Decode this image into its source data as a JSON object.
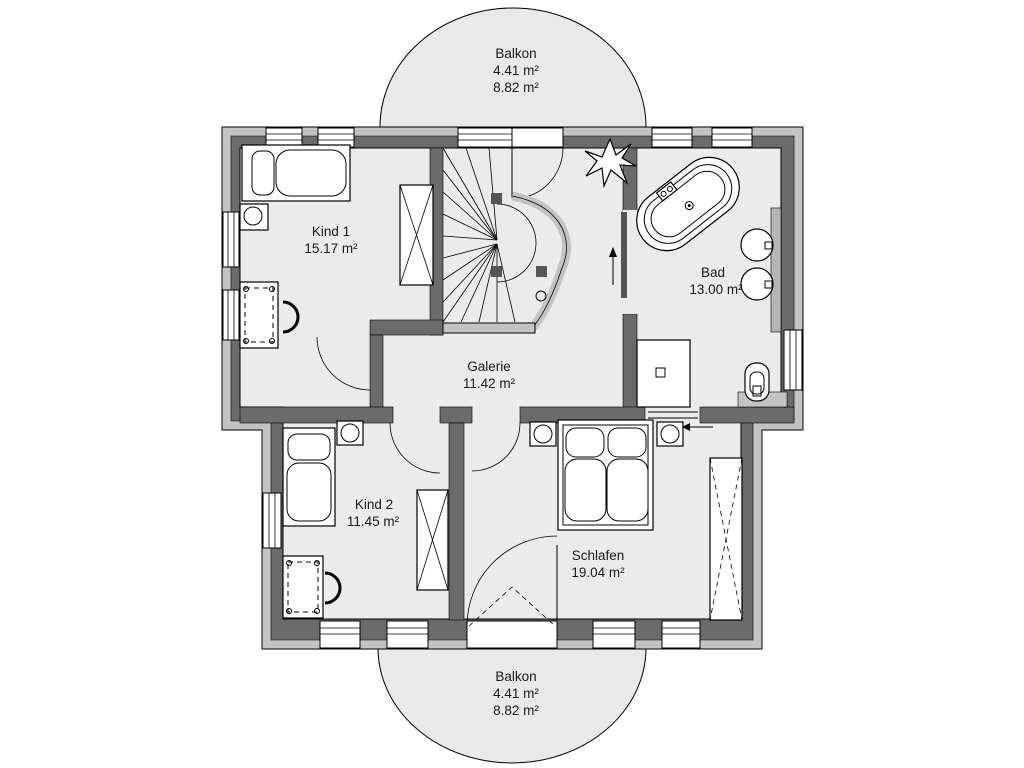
{
  "plan": {
    "rooms": [
      {
        "id": "kind1",
        "name": "Kind 1",
        "area": "15.17 m²"
      },
      {
        "id": "bad",
        "name": "Bad",
        "area": "13.00 m²"
      },
      {
        "id": "galerie",
        "name": "Galerie",
        "area": "11.42 m²"
      },
      {
        "id": "kind2",
        "name": "Kind 2",
        "area": "11.45 m²"
      },
      {
        "id": "schlafen",
        "name": "Schlafen",
        "area": "19.04 m²"
      }
    ],
    "balconies": [
      {
        "id": "balkon-top",
        "name": "Balkon",
        "area1": "4.41 m²",
        "area2": "8.82 m²"
      },
      {
        "id": "balkon-bottom",
        "name": "Balkon",
        "area1": "4.41 m²",
        "area2": "8.82 m²"
      }
    ],
    "icons": {
      "plant_icon": "star-shaped plant symbol",
      "stair_direction_icon": "up-arrow",
      "entry_arrow_icon": "left-arrow"
    },
    "colors": {
      "wall_dark": "#6b6b6b",
      "wall_light": "#c3c3c3",
      "floor": "#ebebeb",
      "balcony": "#e9e9e9",
      "line": "#000000"
    }
  }
}
